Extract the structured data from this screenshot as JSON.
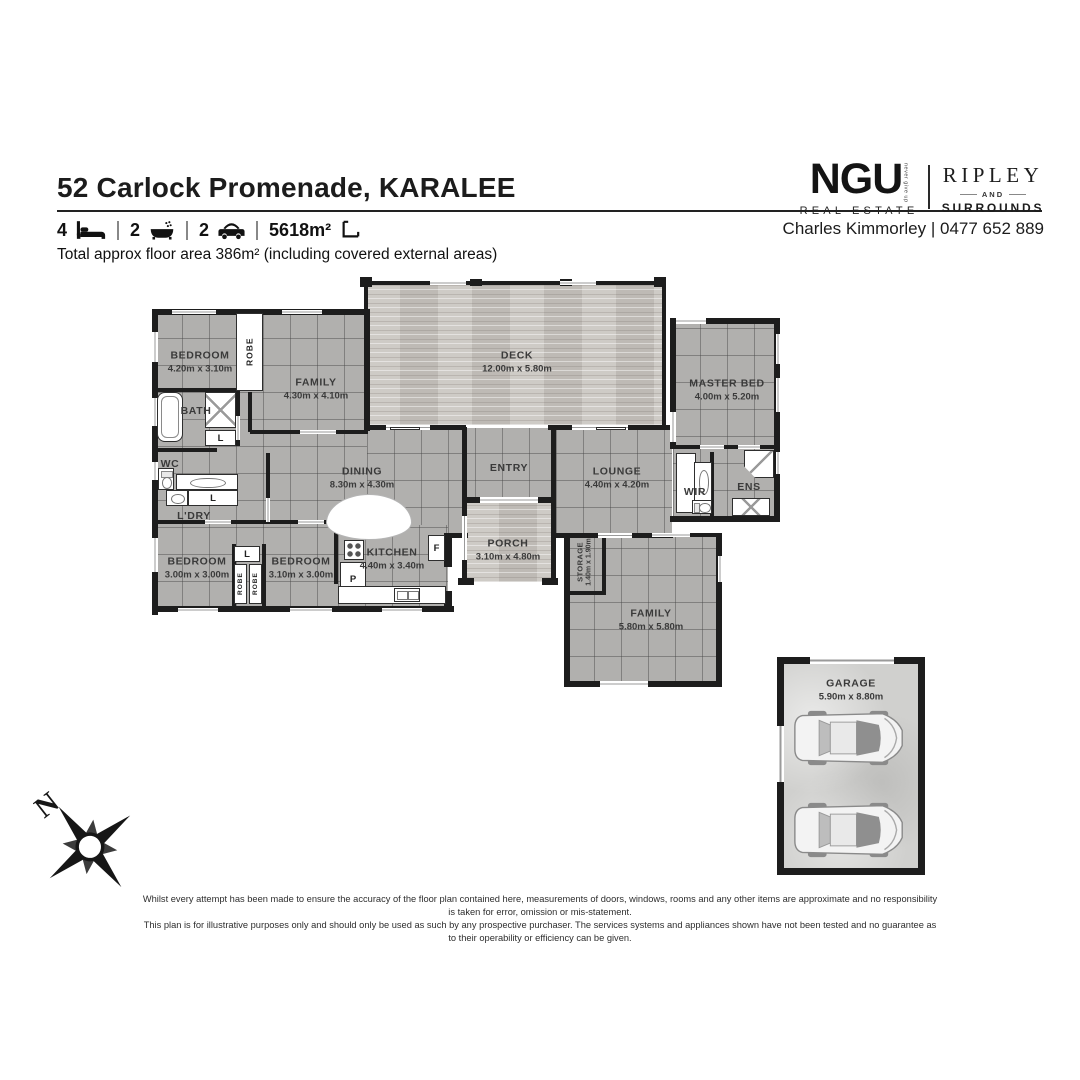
{
  "header": {
    "title": "52 Carlock Promenade, KARALEE",
    "features": {
      "beds": "4",
      "baths": "2",
      "cars": "2",
      "land": "5618m²"
    },
    "floor_area_note": "Total approx floor area 386m² (including covered external areas)"
  },
  "branding": {
    "ngu": "NGU",
    "ngu_tagline": "never give up",
    "ngu_sub": "REAL ESTATE",
    "ripley": "RIPLEY",
    "ripley_and": "AND",
    "ripley_sub": "SURROUNDS",
    "agent": "Charles Kimmorley | 0477 652 889"
  },
  "compass": {
    "north": "N"
  },
  "disclaimer": {
    "line1": "Whilst every attempt has been made to ensure the accuracy of the floor plan contained here, measurements of doors, windows, rooms and any other items are approximate and no responsibility is taken for error, omission or mis-statement.",
    "line2": "This plan is for illustrative purposes only and should only be used as such by any prospective purchaser. The services systems and appliances shown have not been tested and no guarantee as to their operability or efficiency can be given."
  },
  "floorplan": {
    "floors": [
      {
        "name": "left-wing",
        "type": "tile",
        "x": 155,
        "y": 312,
        "w": 212,
        "h": 297
      },
      {
        "name": "mid-band",
        "type": "tile",
        "x": 367,
        "y": 428,
        "w": 305,
        "h": 107
      },
      {
        "name": "master-wing",
        "type": "tile",
        "x": 673,
        "y": 321,
        "w": 104,
        "h": 197
      },
      {
        "name": "kitchen-band",
        "type": "tile",
        "x": 338,
        "y": 525,
        "w": 110,
        "h": 84
      },
      {
        "name": "family-block",
        "type": "tile",
        "x": 567,
        "y": 535,
        "w": 152,
        "h": 149
      },
      {
        "name": "deck",
        "type": "wood",
        "x": 366,
        "y": 283,
        "w": 298,
        "h": 142
      },
      {
        "name": "porch",
        "type": "wood",
        "x": 465,
        "y": 500,
        "w": 88,
        "h": 82
      },
      {
        "name": "garage",
        "type": "concrete",
        "x": 782,
        "y": 662,
        "w": 138,
        "h": 208
      }
    ],
    "walls": [
      [
        152,
        309,
        218,
        6
      ],
      [
        152,
        309,
        6,
        306
      ],
      [
        152,
        606,
        302,
        6
      ],
      [
        364,
        309,
        6,
        122
      ],
      [
        670,
        318,
        6,
        130
      ],
      [
        670,
        318,
        110,
        6
      ],
      [
        774,
        318,
        6,
        204
      ],
      [
        670,
        516,
        110,
        6
      ],
      [
        564,
        533,
        6,
        154
      ],
      [
        564,
        681,
        158,
        6
      ],
      [
        716,
        533,
        6,
        154
      ],
      [
        610,
        533,
        110,
        4
      ],
      [
        564,
        533,
        44,
        4
      ],
      [
        602,
        533,
        4,
        62
      ],
      [
        564,
        591,
        42,
        4
      ],
      [
        782,
        657,
        143,
        7
      ],
      [
        777,
        657,
        7,
        218
      ],
      [
        918,
        657,
        7,
        218
      ],
      [
        777,
        868,
        148,
        7
      ],
      [
        777,
        657,
        10,
        7
      ],
      [
        155,
        388,
        84,
        4
      ],
      [
        236,
        388,
        4,
        58
      ],
      [
        155,
        448,
        62,
        4
      ],
      [
        248,
        392,
        4,
        40
      ],
      [
        266,
        453,
        4,
        70
      ],
      [
        250,
        430,
        118,
        4
      ],
      [
        155,
        520,
        212,
        4
      ],
      [
        232,
        544,
        4,
        62
      ],
      [
        262,
        544,
        4,
        62
      ],
      [
        334,
        524,
        4,
        60
      ],
      [
        444,
        533,
        8,
        34
      ],
      [
        444,
        591,
        8,
        21
      ],
      [
        446,
        533,
        22,
        5
      ],
      [
        364,
        425,
        102,
        5
      ],
      [
        548,
        425,
        124,
        5
      ],
      [
        462,
        427,
        5,
        74
      ],
      [
        551,
        427,
        5,
        74
      ],
      [
        462,
        497,
        18,
        6
      ],
      [
        538,
        497,
        18,
        6
      ],
      [
        462,
        503,
        5,
        82
      ],
      [
        551,
        503,
        5,
        82
      ],
      [
        458,
        578,
        16,
        7
      ],
      [
        542,
        578,
        16,
        7
      ],
      [
        553,
        533,
        120,
        5
      ],
      [
        670,
        445,
        110,
        4
      ],
      [
        710,
        452,
        4,
        64
      ],
      [
        364,
        281,
        302,
        4
      ],
      [
        662,
        281,
        4,
        146
      ],
      [
        364,
        281,
        4,
        34
      ],
      [
        360,
        277,
        12,
        10
      ],
      [
        654,
        277,
        12,
        10
      ],
      [
        470,
        279,
        12,
        7
      ],
      [
        560,
        279,
        12,
        7
      ]
    ],
    "white_gaps": [
      [
        172,
        310,
        44,
        4
      ],
      [
        282,
        310,
        40,
        4
      ],
      [
        152,
        332,
        6,
        30
      ],
      [
        152,
        398,
        6,
        28
      ],
      [
        152,
        462,
        6,
        18
      ],
      [
        152,
        538,
        6,
        34
      ],
      [
        178,
        608,
        40,
        4
      ],
      [
        290,
        608,
        42,
        4
      ],
      [
        382,
        608,
        40,
        4
      ],
      [
        205,
        520,
        26,
        4
      ],
      [
        298,
        520,
        26,
        4
      ],
      [
        300,
        430,
        36,
        4
      ],
      [
        266,
        498,
        4,
        24
      ],
      [
        236,
        416,
        4,
        24
      ],
      [
        676,
        318,
        30,
        6
      ],
      [
        776,
        334,
        4,
        30
      ],
      [
        776,
        378,
        4,
        34
      ],
      [
        776,
        452,
        4,
        22
      ],
      [
        670,
        412,
        6,
        30
      ],
      [
        700,
        445,
        24,
        4
      ],
      [
        738,
        445,
        22,
        4
      ],
      [
        598,
        533,
        34,
        5
      ],
      [
        652,
        533,
        38,
        4
      ],
      [
        718,
        556,
        4,
        26
      ],
      [
        600,
        681,
        48,
        6
      ],
      [
        810,
        657,
        84,
        7
      ],
      [
        777,
        726,
        7,
        56
      ],
      [
        430,
        281,
        36,
        4
      ],
      [
        560,
        281,
        36,
        4
      ],
      [
        386,
        425,
        44,
        5
      ],
      [
        572,
        425,
        56,
        5
      ],
      [
        480,
        497,
        58,
        6
      ],
      [
        462,
        516,
        5,
        44
      ]
    ],
    "fixtures": [
      {
        "name": "robe-top",
        "shape": "box",
        "x": 236,
        "y": 313,
        "w": 27,
        "h": 78,
        "label": "ROBE",
        "vert": true
      },
      {
        "name": "bathtub",
        "shape": "tub",
        "x": 157,
        "y": 392,
        "w": 26,
        "h": 50
      },
      {
        "name": "shower",
        "shape": "shower",
        "x": 205,
        "y": 392,
        "w": 31,
        "h": 36
      },
      {
        "name": "linen-bath",
        "shape": "box",
        "x": 205,
        "y": 430,
        "w": 31,
        "h": 16,
        "label": "L"
      },
      {
        "name": "toilet-wc",
        "shape": "toilet",
        "x": 158,
        "y": 468,
        "w": 16,
        "h": 22
      },
      {
        "name": "vanity-wc",
        "shape": "oval",
        "x": 176,
        "y": 474,
        "w": 62,
        "h": 16
      },
      {
        "name": "laundry-tub",
        "shape": "sink1",
        "x": 166,
        "y": 490,
        "w": 22,
        "h": 16
      },
      {
        "name": "linen-ldry",
        "shape": "box",
        "x": 188,
        "y": 490,
        "w": 50,
        "h": 16,
        "label": "L"
      },
      {
        "name": "linen-hall",
        "shape": "box",
        "x": 234,
        "y": 546,
        "w": 26,
        "h": 16,
        "label": "L"
      },
      {
        "name": "robe-bed2",
        "shape": "box",
        "x": 234,
        "y": 564,
        "w": 13,
        "h": 40,
        "label": "ROBE",
        "vert": true,
        "tiny": true
      },
      {
        "name": "robe-bed3",
        "shape": "box",
        "x": 249,
        "y": 564,
        "w": 13,
        "h": 40,
        "label": "ROBE",
        "vert": true,
        "tiny": true
      },
      {
        "name": "stove",
        "shape": "burners",
        "x": 344,
        "y": 540,
        "w": 20,
        "h": 20
      },
      {
        "name": "pantry",
        "shape": "box",
        "x": 340,
        "y": 562,
        "w": 26,
        "h": 34,
        "label": "P"
      },
      {
        "name": "fridge",
        "shape": "box",
        "x": 428,
        "y": 535,
        "w": 17,
        "h": 26,
        "label": "F"
      },
      {
        "name": "kitchen-bench",
        "shape": "box",
        "x": 338,
        "y": 586,
        "w": 108,
        "h": 18
      },
      {
        "name": "kitchen-sink",
        "shape": "sink2",
        "x": 394,
        "y": 588,
        "w": 26,
        "h": 14
      },
      {
        "name": "kitchen-arch",
        "shape": "arch",
        "x": 326,
        "y": 494,
        "w": 86,
        "h": 46
      },
      {
        "name": "wir-shelf",
        "shape": "box",
        "x": 676,
        "y": 453,
        "w": 20,
        "h": 60
      },
      {
        "name": "wir-vanity",
        "shape": "oval",
        "x": 694,
        "y": 462,
        "w": 18,
        "h": 40
      },
      {
        "name": "toilet-ens",
        "shape": "toilet-h",
        "x": 692,
        "y": 500,
        "w": 20,
        "h": 14
      },
      {
        "name": "ens-shower-corner",
        "shape": "pent",
        "x": 744,
        "y": 450,
        "w": 30,
        "h": 28
      },
      {
        "name": "ens-shower",
        "shape": "shower",
        "x": 732,
        "y": 498,
        "w": 38,
        "h": 18
      },
      {
        "name": "slider-deck-west",
        "shape": "bar",
        "x": 390,
        "y": 427,
        "w": 30,
        "h": 3
      },
      {
        "name": "slider-deck-east",
        "shape": "bar",
        "x": 596,
        "y": 427,
        "w": 30,
        "h": 3
      }
    ],
    "labels": [
      {
        "id": "bedroom1",
        "name": "BEDROOM",
        "dims": "4.20m x 3.10m",
        "cx": 200,
        "cy": 362
      },
      {
        "id": "family1",
        "name": "FAMILY",
        "dims": "4.30m x 4.10m",
        "cx": 316,
        "cy": 389
      },
      {
        "id": "deck",
        "name": "DECK",
        "dims": "12.00m x 5.80m",
        "cx": 517,
        "cy": 362
      },
      {
        "id": "master-bed",
        "name": "MASTER BED",
        "dims": "4.00m x 5.20m",
        "cx": 727,
        "cy": 390
      },
      {
        "id": "bath",
        "name": "BATH",
        "cx": 196,
        "cy": 411
      },
      {
        "id": "wc",
        "name": "WC",
        "cx": 170,
        "cy": 464
      },
      {
        "id": "ldry",
        "name": "L'DRY",
        "cx": 194,
        "cy": 516
      },
      {
        "id": "dining",
        "name": "DINING",
        "dims": "8.30m x 4.30m",
        "cx": 362,
        "cy": 478
      },
      {
        "id": "entry",
        "name": "ENTRY",
        "cx": 509,
        "cy": 468
      },
      {
        "id": "lounge",
        "name": "LOUNGE",
        "dims": "4.40m x 4.20m",
        "cx": 617,
        "cy": 478
      },
      {
        "id": "wir",
        "name": "WIR",
        "cx": 695,
        "cy": 492
      },
      {
        "id": "ens",
        "name": "ENS",
        "cx": 749,
        "cy": 487
      },
      {
        "id": "porch",
        "name": "PORCH",
        "dims": "3.10m x 4.80m",
        "cx": 508,
        "cy": 550
      },
      {
        "id": "storage",
        "name": "STORAGE",
        "dims": "1.40m x 1.90m",
        "cx": 584,
        "cy": 562,
        "rotate": true,
        "small": true
      },
      {
        "id": "bedroom2",
        "name": "BEDROOM",
        "dims": "3.00m x 3.00m",
        "cx": 197,
        "cy": 568
      },
      {
        "id": "bedroom3",
        "name": "BEDROOM",
        "dims": "3.10m x 3.00m",
        "cx": 301,
        "cy": 568
      },
      {
        "id": "kitchen",
        "name": "KITCHEN",
        "dims": "4.40m x 3.40m",
        "cx": 392,
        "cy": 559
      },
      {
        "id": "family2",
        "name": "FAMILY",
        "dims": "5.80m x 5.80m",
        "cx": 651,
        "cy": 620
      },
      {
        "id": "garage",
        "name": "GARAGE",
        "dims": "5.90m x 8.80m",
        "cx": 851,
        "cy": 690
      }
    ],
    "cars": [
      {
        "x": 790,
        "y": 710
      },
      {
        "x": 790,
        "y": 802
      }
    ]
  }
}
